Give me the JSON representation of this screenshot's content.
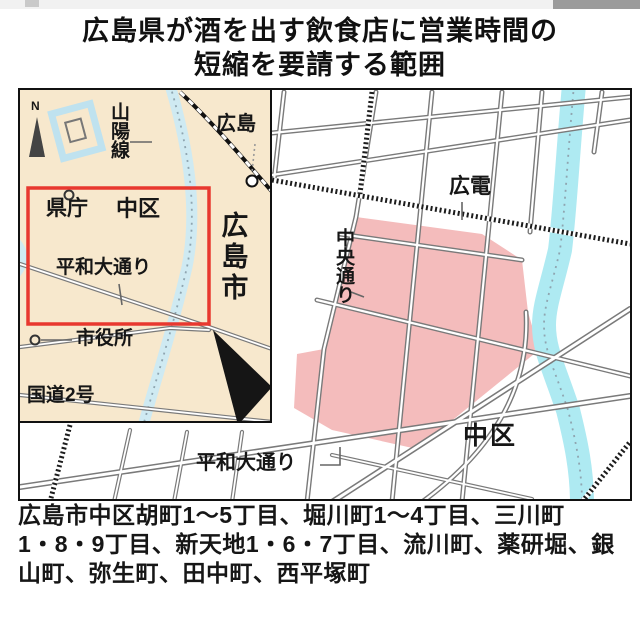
{
  "title": {
    "line1": "広島県が酒を出す飲食店に営業時間の",
    "line2": "短縮を要請する範囲"
  },
  "inset": {
    "north_label": "N",
    "sanyo_line": "山陽線",
    "hiroshima_station": "広島",
    "prefectural_office": "県庁",
    "naka_ward": "中区",
    "peace_boulevard": "平和大通り",
    "city_hall": "市役所",
    "route2": "国道2号",
    "hiroshima_city": "広島市"
  },
  "main_map": {
    "hiroden": "広電",
    "chuo_dori": "中央通り",
    "peace_boulevard": "平和大通り",
    "naka_ward": "中区"
  },
  "caption": {
    "line1": "広島市中区胡町1〜5丁目、堀川町1〜4丁目、三川町",
    "line2": "1・8・9丁目、新天地1・6・7丁目、流川町、薬研堀、銀",
    "line3": "山町、弥生町、田中町、西平塚町"
  },
  "colors": {
    "highlight_pink": "#f4bcbc",
    "river_cyan": "#aeeaf2",
    "inset_river_cyan": "#cfeaf2",
    "inset_cream": "#f7e8cd",
    "frame_red": "#e8382f"
  }
}
